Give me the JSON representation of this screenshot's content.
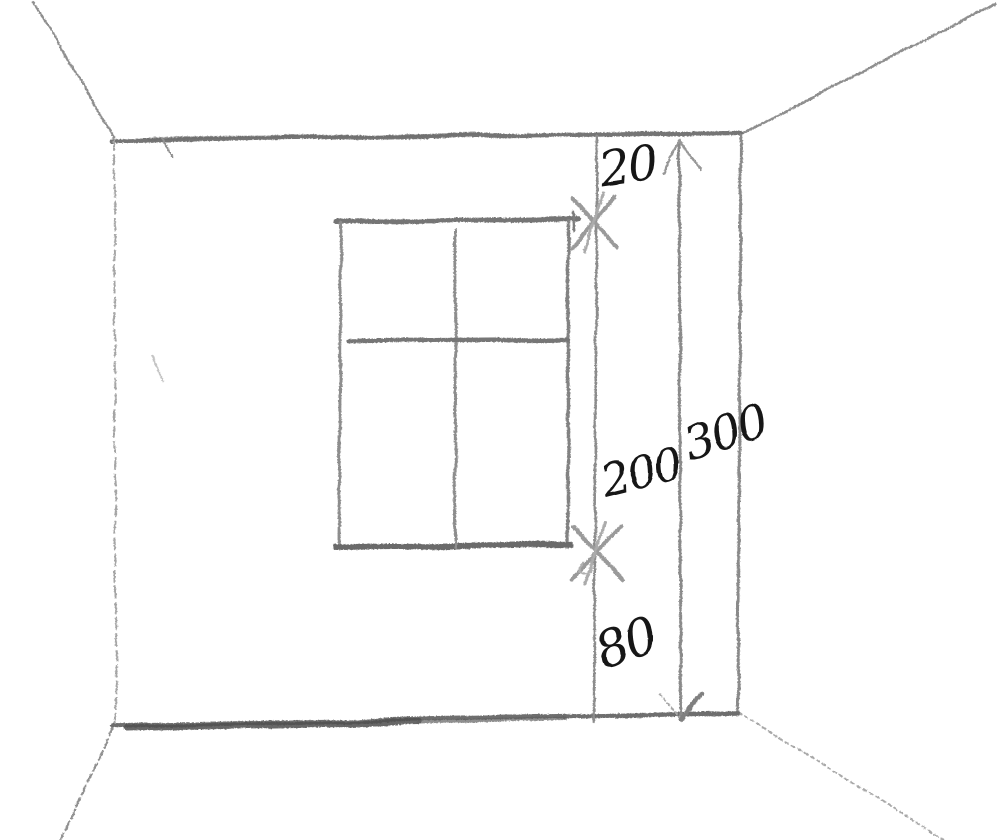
{
  "sketch": {
    "type": "hand-drawn-room-perspective",
    "dimension_labels": {
      "above_window": "20",
      "window_height": "200",
      "below_window": "80",
      "wall_total": "300"
    },
    "colors": {
      "paper": "#ffffff",
      "pencil_light": "#a5a5a5",
      "pencil": "#8a8a8a",
      "pencil_dark": "#5e5e5e",
      "ink": "#161616"
    }
  }
}
